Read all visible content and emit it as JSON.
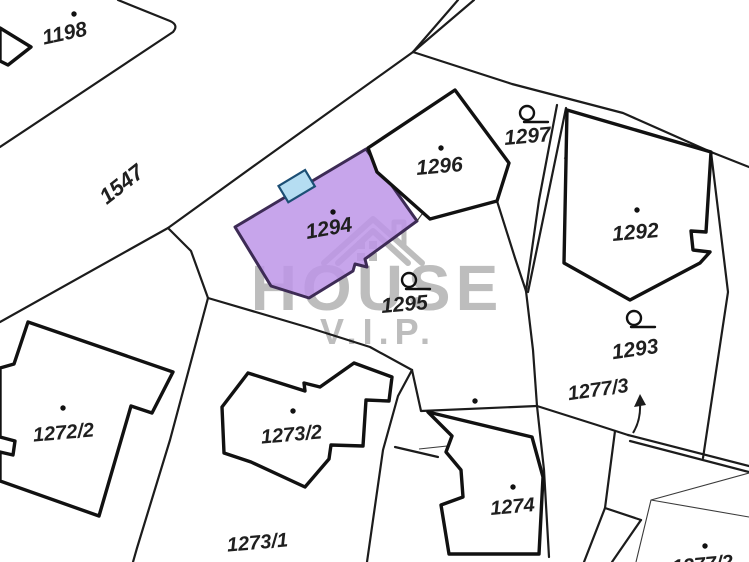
{
  "map": {
    "type": "cadastral-parcel-map",
    "background": "#ffffff",
    "line_color": "#1c1c1c",
    "label_color": "#1f1f1f",
    "watermark": {
      "line1": "HOUSE",
      "line2": "V.I.P.",
      "color": "#bdbdbd",
      "house_icon": "house-roof-with-chimney-and-windows"
    },
    "highlight": {
      "parcel": "1294",
      "fill": "#bd95e8",
      "stroke": "#3d2b55",
      "building_fill": "#b5ddf2",
      "building_stroke": "#1c4f75"
    },
    "road_label": "1547",
    "parcels": [
      {
        "id": "1198",
        "label": "1198",
        "x": 66,
        "y": 40,
        "rot": -12,
        "size": 21,
        "dot": {
          "x": 74,
          "y": 14
        },
        "loop": null
      },
      {
        "id": "1547",
        "label": "1547",
        "x": 126,
        "y": 190,
        "rot": -38,
        "size": 22,
        "dot": null,
        "loop": null
      },
      {
        "id": "1294",
        "label": "1294",
        "x": 330,
        "y": 235,
        "rot": -10,
        "size": 21,
        "dot": {
          "x": 333,
          "y": 212
        },
        "loop": null
      },
      {
        "id": "1296",
        "label": "1296",
        "x": 440,
        "y": 173,
        "rot": -5,
        "size": 21,
        "dot": {
          "x": 441,
          "y": 148
        },
        "loop": null
      },
      {
        "id": "1297",
        "label": "1297",
        "x": 528,
        "y": 143,
        "rot": -5,
        "size": 21,
        "dot": null,
        "loop": {
          "x": 527,
          "y": 113
        }
      },
      {
        "id": "1292",
        "label": "1292",
        "x": 636,
        "y": 239,
        "rot": -5,
        "size": 21,
        "dot": {
          "x": 637,
          "y": 210
        },
        "loop": null
      },
      {
        "id": "1293",
        "label": "1293",
        "x": 636,
        "y": 356,
        "rot": -8,
        "size": 21,
        "dot": null,
        "loop": {
          "x": 634,
          "y": 318
        }
      },
      {
        "id": "1295",
        "label": "1295",
        "x": 405,
        "y": 311,
        "rot": -5,
        "size": 21,
        "dot": null,
        "loop": {
          "x": 409,
          "y": 280
        }
      },
      {
        "id": "1277/3",
        "label": "1277/3",
        "x": 599,
        "y": 396,
        "rot": -8,
        "size": 20,
        "dot": null,
        "loop": null
      },
      {
        "id": "1272/2",
        "label": "1272/2",
        "x": 64,
        "y": 439,
        "rot": -5,
        "size": 20,
        "dot": {
          "x": 63,
          "y": 408
        },
        "loop": null
      },
      {
        "id": "1273/2",
        "label": "1273/2",
        "x": 292,
        "y": 441,
        "rot": -5,
        "size": 20,
        "dot": {
          "x": 293,
          "y": 411
        },
        "loop": null
      },
      {
        "id": "1273/1",
        "label": "1273/1",
        "x": 258,
        "y": 549,
        "rot": -5,
        "size": 20,
        "dot": null,
        "loop": null
      },
      {
        "id": "1274",
        "label": "1274",
        "x": 513,
        "y": 513,
        "rot": -5,
        "size": 20,
        "dot": {
          "x": 513,
          "y": 487
        },
        "loop": null
      },
      {
        "id": "1277/2",
        "label": "1277/2",
        "x": 703,
        "y": 571,
        "rot": -5,
        "size": 20,
        "dot": {
          "x": 705,
          "y": 546
        },
        "loop": null
      }
    ],
    "extra_dots": [
      {
        "x": 475,
        "y": 401
      }
    ],
    "arrow": {
      "for_parcel": "1277/3",
      "tail_x": 633,
      "tail_y": 433,
      "tip_x": 640,
      "tip_y": 400
    }
  }
}
